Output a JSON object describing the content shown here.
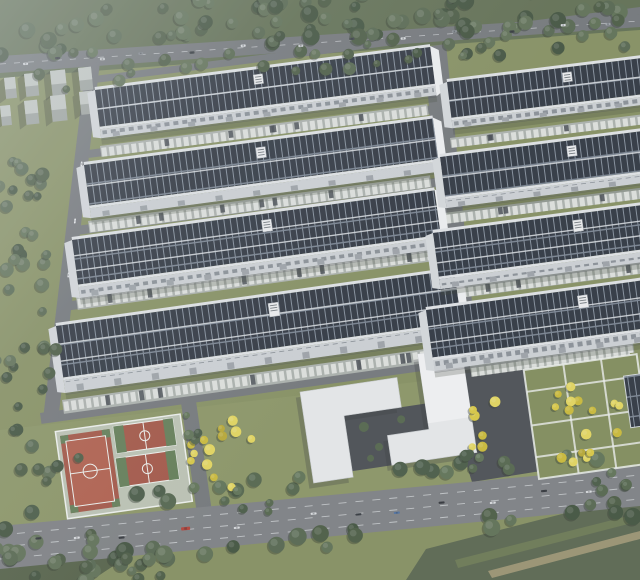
{
  "meta": {
    "description": "aerial 3D architectural rendering of a solar-rooftop industrial park campus",
    "canvas": {
      "w": 640,
      "h": 580
    },
    "seed": 7
  },
  "palette": {
    "grass": "#828d5c",
    "grass_bright": "#8d9765",
    "grass_dark": "#5c6b4d",
    "panel": "#29303a",
    "panel_gap": "#8995a2",
    "panel_walk": "#77828f",
    "bank_line": "#d3d8db",
    "ridge": "#dfe2e5",
    "facade": "#cbd0d3",
    "window": "#868d93",
    "dock_door": "#9aa0a5",
    "gable": "#eef0f1",
    "gable_left": "#d4d8db",
    "road": "#6f7376",
    "main_road": "#7a7d80",
    "lane_line": "#d6d9db",
    "plaza": "#464a4e",
    "courtyard": "#45494d",
    "strip_base": "#a9afaa",
    "stall": "#e3e6e2",
    "dark_car": "#3e444a",
    "white_bldg": "#e6e8e9",
    "white_bldg_hi": "#f1f2f3",
    "block_side": "#9ba19c",
    "block_top": "#c2c7c2",
    "court_red": "#a0503f",
    "court_red_in": "#ad5945",
    "court_green": "#5d7950",
    "court_frame": "#b9c1b1",
    "white_line": "#eef1ec",
    "field": "#55624a",
    "field_strip": "#67754e",
    "field_tan": "#9e9671",
    "shadow": "rgba(45,52,40,0.35)",
    "haze": "218,225,231"
  },
  "tree_palettes": {
    "forest": [
      "#46573e",
      "#51634a",
      "#3c4e38",
      "#5a6c50"
    ],
    "green2": [
      "#4e6147",
      "#5b6f51",
      "#435640"
    ],
    "yellow": [
      "#d7c73e",
      "#c9b832",
      "#e2d558",
      "#b5a52d"
    ]
  },
  "ground_zones": [
    {
      "pts": [
        [
          0,
          0
        ],
        [
          640,
          0
        ],
        [
          640,
          30
        ],
        [
          0,
          78
        ]
      ],
      "fill": "#5c6b4d",
      "op": 1
    },
    {
      "pts": [
        [
          0,
          430
        ],
        [
          640,
          356
        ],
        [
          640,
          468
        ],
        [
          0,
          532
        ]
      ],
      "fill": "#8d9765",
      "op": 0.55
    }
  ],
  "fields": [
    {
      "pts": [
        [
          426,
          549
        ],
        [
          640,
          494
        ],
        [
          640,
          580
        ],
        [
          406,
          580
        ]
      ],
      "fill": "#55624a",
      "op": 1
    },
    {
      "pts": [
        [
          455,
          560
        ],
        [
          640,
          513
        ],
        [
          640,
          521
        ],
        [
          458,
          568
        ]
      ],
      "fill": "#67754e",
      "op": 1
    },
    {
      "pts": [
        [
          488,
          571
        ],
        [
          640,
          531
        ],
        [
          640,
          539
        ],
        [
          492,
          578
        ]
      ],
      "fill": "#9e9671",
      "op": 0.9
    },
    {
      "pts": [
        [
          0,
          540
        ],
        [
          150,
          542
        ],
        [
          92,
          580
        ],
        [
          0,
          580
        ]
      ],
      "fill": "#4f5c42",
      "op": 1
    }
  ],
  "roads": {
    "top_road": [
      [
        0,
        56
      ],
      [
        640,
        14
      ],
      [
        640,
        27
      ],
      [
        0,
        73
      ]
    ],
    "left_road": [
      [
        86,
        64
      ],
      [
        100,
        62
      ],
      [
        58,
        421
      ],
      [
        43,
        419
      ]
    ],
    "central_road": [
      [
        424,
        47
      ],
      [
        446,
        44
      ],
      [
        479,
        371
      ],
      [
        451,
        374
      ]
    ],
    "park_road": [
      [
        180,
        396
      ],
      [
        195,
        394
      ],
      [
        212,
        512
      ],
      [
        197,
        514
      ]
    ],
    "main_road": [
      [
        0,
        526
      ],
      [
        640,
        466
      ],
      [
        640,
        506
      ],
      [
        0,
        569
      ]
    ],
    "plaza": [
      [
        438,
        373
      ],
      [
        532,
        362
      ],
      [
        566,
        467
      ],
      [
        472,
        482
      ]
    ],
    "row_roads": [
      {
        "x": 94,
        "y": 76,
        "len": 552,
        "h": 7,
        "ang": -7.2
      },
      {
        "x": 88,
        "y": 150,
        "len": 558,
        "h": 8,
        "ang": -7.4
      },
      {
        "x": 76,
        "y": 226,
        "len": 570,
        "h": 9,
        "ang": -7.6
      },
      {
        "x": 64,
        "y": 302,
        "len": 582,
        "h": 9,
        "ang": -7.8
      },
      {
        "x": 40,
        "y": 413,
        "len": 606,
        "h": 11,
        "ang": -7.9
      }
    ],
    "top_dash_line": [
      [
        0,
        64
      ],
      [
        640,
        21
      ]
    ],
    "main_lines": [
      [
        [
          0,
          535
        ],
        [
          640,
          475
        ]
      ],
      [
        [
          0,
          547
        ],
        [
          640,
          487
        ]
      ],
      [
        [
          0,
          559
        ],
        [
          640,
          499
        ]
      ]
    ]
  },
  "factories": [
    {
      "id": "L1",
      "x": 95,
      "y": 90,
      "len": 338,
      "roof": 37,
      "fac": 9,
      "ang": -7.3,
      "label": 0.47,
      "cap": 1
    },
    {
      "id": "L2",
      "x": 84,
      "y": 165,
      "len": 352,
      "roof": 41,
      "fac": 10,
      "ang": -7.6,
      "label": 0.49,
      "cap": 1
    },
    {
      "id": "L3",
      "x": 72,
      "y": 240,
      "len": 366,
      "roof": 45,
      "fac": 11,
      "ang": -7.8,
      "label": 0.52,
      "cap": 1
    },
    {
      "id": "L4",
      "x": 56,
      "y": 326,
      "len": 402,
      "roof": 52,
      "fac": 13,
      "ang": -8.0,
      "label": 0.53,
      "cap": 1
    },
    {
      "id": "R1",
      "x": 447,
      "y": 82,
      "len": 210,
      "roof": 36,
      "fac": 8,
      "ang": -7.0,
      "label": 0.55,
      "cap": 0
    },
    {
      "id": "R2",
      "x": 440,
      "y": 157,
      "len": 215,
      "roof": 40,
      "fac": 9,
      "ang": -7.3,
      "label": 0.59,
      "cap": 0
    },
    {
      "id": "R3",
      "x": 433,
      "y": 233,
      "len": 222,
      "roof": 44,
      "fac": 10,
      "ang": -7.6,
      "label": 0.63,
      "cap": 0
    },
    {
      "id": "R4",
      "x": 426,
      "y": 310,
      "len": 230,
      "roof": 48,
      "fac": 11,
      "ang": -7.8,
      "label": 0.66,
      "cap": 0
    }
  ],
  "parking_strips": [
    {
      "x": 100,
      "y": 146,
      "len": 330,
      "h": 11,
      "ang": -7.3
    },
    {
      "x": 88,
      "y": 221,
      "len": 345,
      "h": 12,
      "ang": -7.6
    },
    {
      "x": 76,
      "y": 297,
      "len": 360,
      "h": 13,
      "ang": -7.8
    },
    {
      "x": 62,
      "y": 400,
      "len": 395,
      "h": 14,
      "ang": -8.0
    },
    {
      "x": 450,
      "y": 138,
      "len": 195,
      "h": 10,
      "ang": -7.0
    },
    {
      "x": 444,
      "y": 213,
      "len": 200,
      "h": 11,
      "ang": -7.3
    },
    {
      "x": 437,
      "y": 289,
      "len": 206,
      "h": 12,
      "ang": -7.6
    },
    {
      "x": 470,
      "y": 366,
      "len": 160,
      "h": 11,
      "ang": -7.8
    }
  ],
  "utility_blocks": {
    "angle": -6,
    "blocks": [
      [
        4,
        78,
        11,
        21
      ],
      [
        24,
        74,
        13,
        23
      ],
      [
        50,
        71,
        15,
        25
      ],
      [
        78,
        68,
        13,
        23
      ],
      [
        0,
        106,
        10,
        20
      ],
      [
        24,
        101,
        13,
        24
      ],
      [
        50,
        96,
        15,
        26
      ],
      [
        79,
        92,
        13,
        23
      ]
    ]
  },
  "sports": {
    "tx": 60,
    "ty": 436,
    "ang": -8,
    "frame": {
      "x": -4,
      "y": -5,
      "w": 126,
      "h": 88
    },
    "big": {
      "x": 0,
      "y": 0,
      "w": 50,
      "h": 78
    },
    "small": [
      {
        "x": 54,
        "y": -2,
        "w": 60,
        "h": 27
      },
      {
        "x": 52,
        "y": 30,
        "w": 60,
        "h": 29
      }
    ]
  },
  "office": {
    "tx": 300,
    "ty": 392,
    "ang": -8.5,
    "courtyard": "M40,30L122,30L122,56L80,56L80,86L40,86Z",
    "a_path": "M0,0L98,0L98,30L40,30L40,92L0,92Z",
    "b_path": "M122,-20L166,-20L166,86L80,86L80,56L122,56Z",
    "tower": {
      "x": 122,
      "y": -20,
      "w": 44,
      "h": 70
    },
    "bushes": [
      [
        58,
        44,
        5
      ],
      [
        70,
        66,
        4
      ],
      [
        96,
        42,
        4
      ],
      [
        60,
        76,
        3.5
      ]
    ]
  },
  "garden": {
    "tx": 524,
    "ty": 372,
    "ang": -8,
    "base": {
      "x": 0,
      "y": -2,
      "w": 114,
      "h": 110
    },
    "hpaths": [
      20,
      54,
      86
    ],
    "vpaths": [
      40,
      78
    ],
    "parking": {
      "x": -4,
      "y": -17,
      "w": 116,
      "h": 13
    },
    "carport": {
      "x": 98,
      "y": 18,
      "w": 36,
      "h": 52
    }
  },
  "tree_bands": [
    {
      "line": [
        0,
        30,
        640,
        6
      ],
      "spread": 26,
      "n": 85,
      "rmin": 4.5,
      "rmax": 8.5,
      "pal": "forest"
    },
    {
      "line": [
        0,
        84,
        640,
        34
      ],
      "spread": 12,
      "n": 30,
      "rmin": 3.5,
      "rmax": 6.5,
      "pal": "forest"
    },
    {
      "line": [
        0,
        510,
        640,
        452
      ],
      "spread": 7,
      "n": 20,
      "rmin": 5,
      "rmax": 8,
      "pal": "green2"
    },
    {
      "line": [
        0,
        572,
        640,
        510
      ],
      "spread": 10,
      "n": 24,
      "rmin": 5.5,
      "rmax": 9,
      "pal": "forest"
    }
  ],
  "tree_clusters": [
    {
      "c": [
        22,
        185,
        28,
        40
      ],
      "n": 11,
      "rmin": 4,
      "rmax": 7,
      "pal": "forest"
    },
    {
      "c": [
        30,
        278,
        32,
        52
      ],
      "n": 12,
      "rmin": 4,
      "rmax": 7,
      "pal": "forest"
    },
    {
      "c": [
        26,
        372,
        34,
        48
      ],
      "n": 11,
      "rmin": 4,
      "rmax": 7,
      "pal": "forest"
    },
    {
      "c": [
        46,
        448,
        38,
        38
      ],
      "n": 9,
      "rmin": 4,
      "rmax": 7,
      "pal": "forest"
    },
    {
      "c": [
        42,
        554,
        72,
        36
      ],
      "n": 16,
      "rmin": 5,
      "rmax": 9,
      "pal": "forest"
    },
    {
      "c": [
        130,
        568,
        50,
        20
      ],
      "n": 8,
      "rmin": 4,
      "rmax": 7,
      "pal": "forest"
    },
    {
      "c": [
        222,
        458,
        36,
        40
      ],
      "n": 13,
      "rmin": 3.5,
      "rmax": 5.5,
      "pal": "yellow"
    },
    {
      "c": [
        252,
        502,
        36,
        16
      ],
      "n": 5,
      "rmin": 3.5,
      "rmax": 5.5,
      "pal": "green2"
    },
    {
      "c": [
        484,
        430,
        18,
        40
      ],
      "n": 6,
      "rmin": 3.5,
      "rmax": 5.5,
      "pal": "yellow"
    },
    {
      "c": [
        577,
        420,
        48,
        48
      ],
      "n": 16,
      "rmin": 3.5,
      "rmax": 6,
      "pal": "yellow"
    },
    {
      "c": [
        612,
        478,
        28,
        14
      ],
      "n": 5,
      "rmin": 4,
      "rmax": 6,
      "pal": "green2"
    },
    {
      "c": [
        466,
        462,
        24,
        12
      ],
      "n": 4,
      "rmin": 4,
      "rmax": 6,
      "pal": "green2"
    },
    {
      "c": [
        200,
        425,
        16,
        22
      ],
      "n": 4,
      "rmin": 3,
      "rmax": 5,
      "pal": "green2"
    }
  ],
  "cars": {
    "top": {
      "line": [
        0,
        64,
        640,
        21
      ],
      "size": [
        5,
        2.4
      ],
      "list": [
        [
          0.04,
          1.5,
          "#d9dcde"
        ],
        [
          0.09,
          -2,
          "#33383c"
        ],
        [
          0.16,
          2,
          "#c7cacc"
        ],
        [
          0.22,
          -1,
          "#7e8489"
        ],
        [
          0.3,
          1.5,
          "#2f3438"
        ],
        [
          0.38,
          -2,
          "#d9dcde"
        ],
        [
          0.47,
          2,
          "#caced0"
        ],
        [
          0.55,
          -1.5,
          "#3a4044"
        ],
        [
          0.63,
          1.5,
          "#d9dcde"
        ],
        [
          0.71,
          -2,
          "#868c91"
        ],
        [
          0.8,
          2,
          "#2f3438"
        ],
        [
          0.88,
          -1,
          "#d9dcde"
        ],
        [
          0.95,
          1,
          "#9aa0a5"
        ]
      ]
    },
    "main": {
      "line": [
        0,
        546,
        640,
        486
      ],
      "size": [
        6,
        3
      ],
      "list": [
        [
          0.06,
          -4,
          "#2e3236",
          6
        ],
        [
          0.12,
          -1,
          "#dbdee0",
          6
        ],
        [
          0.19,
          3,
          "#2e3236",
          6
        ],
        [
          0.29,
          0,
          "#b23a2f",
          9
        ],
        [
          0.37,
          4,
          "#d9dcde",
          6
        ],
        [
          0.49,
          -3,
          "#dbdee0",
          6
        ],
        [
          0.56,
          2,
          "#31363b",
          6
        ],
        [
          0.62,
          4,
          "#4a6e9e",
          6
        ],
        [
          0.69,
          -2,
          "#2e3236",
          6
        ],
        [
          0.77,
          3,
          "#dbdee0",
          6
        ],
        [
          0.85,
          -4,
          "#2e3236",
          6
        ],
        [
          0.92,
          1,
          "#d9dcde",
          6
        ]
      ]
    },
    "left": {
      "line": [
        93,
        66,
        52,
        416
      ],
      "size": [
        5,
        2.4
      ],
      "list": [
        [
          0.28,
          0,
          "#e8eaec",
          5
        ],
        [
          0.44,
          1,
          "#e8eaec",
          5
        ],
        [
          0.6,
          -1,
          "#dfe2e4",
          5
        ]
      ]
    }
  }
}
